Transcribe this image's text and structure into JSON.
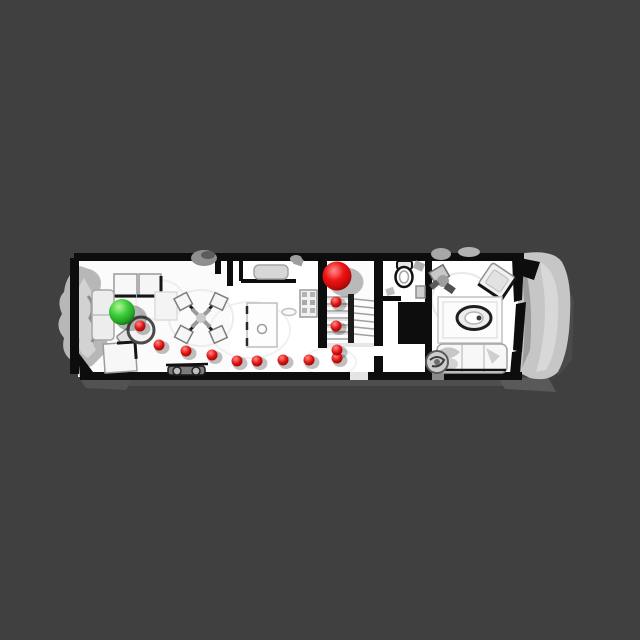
{
  "scene": {
    "title": "top-down-3d-scan-floorplan-navigation",
    "canvas": {
      "width": 640,
      "height": 640
    },
    "colors": {
      "background": "#404040",
      "floor": "#ffffff",
      "walls": "#0d0d0d",
      "scan_noise_gray": "#bfbfbf",
      "start_marker_green": "#32c832",
      "goal_marker_red": "#e01010",
      "waypoint_red": "#dd1414"
    },
    "start_marker": {
      "label": "start-sphere",
      "x": 122,
      "y": 312,
      "radius": 13,
      "color": "#32c832"
    },
    "goal_marker": {
      "label": "goal-sphere",
      "x": 337,
      "y": 276,
      "radius": 14.5,
      "color": "#e01010"
    },
    "path": {
      "waypoint_radius": 5.5,
      "waypoint_color": "#dd1414",
      "waypoints": [
        [
          140,
          326
        ],
        [
          159,
          345
        ],
        [
          186,
          351
        ],
        [
          212,
          355
        ],
        [
          237,
          361
        ],
        [
          257,
          361
        ],
        [
          283,
          360
        ],
        [
          309,
          360
        ],
        [
          337,
          358
        ],
        [
          337,
          350
        ],
        [
          336,
          326
        ],
        [
          336,
          302
        ]
      ]
    }
  }
}
